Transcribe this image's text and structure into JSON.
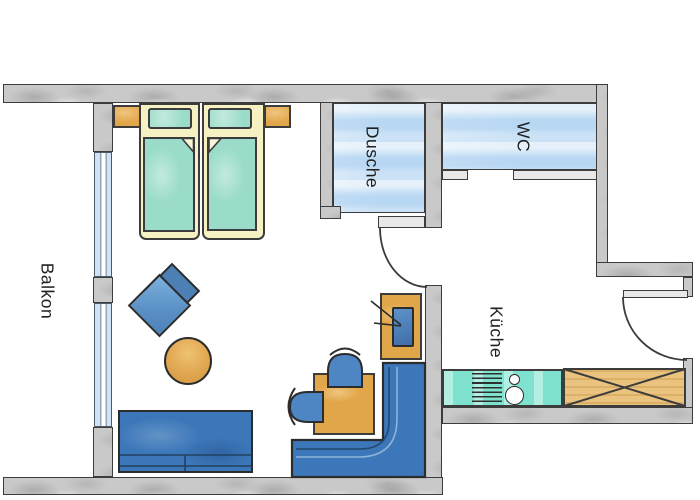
{
  "plan": {
    "labels": {
      "balcony": "Balkon",
      "shower": "Dusche",
      "wc": "WC",
      "kitchen": "Küche"
    },
    "colors": {
      "wall_gray": "#c9c9c9",
      "outline": "#3c3c3c",
      "room_floor_blue": "#cbe2f6",
      "window_blue": "#cfe3f4",
      "bed_frame_cream": "#f5f1c3",
      "mattress_teal": "#9adcc9",
      "furniture_orange": "#e2a64a",
      "wood_cabinet": "#eac47e",
      "counter_teal": "#7ee2cf",
      "sofa_blue": "#3c77b9",
      "chair_blue": "#4d86c2",
      "diamond_back_blue": "#4d80b4",
      "diamond_front_blue": "#639ad0"
    },
    "rooms": [
      {
        "id": "balcony",
        "label": "Balkon"
      },
      {
        "id": "shower",
        "label": "Dusche"
      },
      {
        "id": "wc",
        "label": "WC"
      },
      {
        "id": "kitchen",
        "label": "Küche"
      }
    ],
    "furniture": [
      "double-bed",
      "nightstand-left",
      "nightstand-right",
      "pillow",
      "mattress",
      "diamond-side-tables",
      "round-table",
      "sofa",
      "corner-bench",
      "dining-table",
      "chair",
      "tv-sideboard",
      "tv",
      "kitchen-counter",
      "stove",
      "sink",
      "base-cabinet"
    ],
    "doors": [
      "hall-door",
      "entry-door"
    ]
  }
}
